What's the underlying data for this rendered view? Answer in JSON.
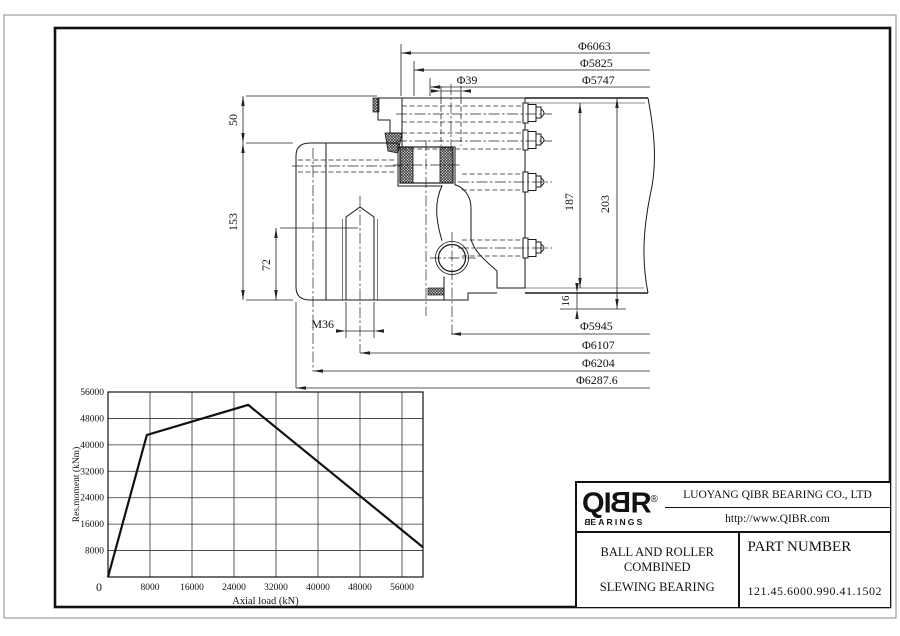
{
  "page": {
    "background": "#ffffff",
    "line_color": "#1a1a1a"
  },
  "drawing": {
    "dims": {
      "d6063": "Φ6063",
      "d5825": "Φ5825",
      "d5747": "Φ5747",
      "d39": "Φ39",
      "d50": "50",
      "d153": "153",
      "d72": "72",
      "d187": "187",
      "d203": "203",
      "d16": "16",
      "m36": "M36",
      "d5945": "Φ5945",
      "d6107": "Φ6107",
      "d6204": "Φ6204",
      "d6287": "Φ6287.6"
    }
  },
  "chart_data": {
    "type": "line",
    "title": "",
    "xlabel": "Axial load (kN)",
    "ylabel": "Res.moment (kNm)",
    "xlim": [
      0,
      60000
    ],
    "ylim": [
      0,
      56000
    ],
    "x_ticks": [
      8000,
      16000,
      24000,
      32000,
      40000,
      48000,
      56000
    ],
    "y_ticks": [
      8000,
      16000,
      24000,
      32000,
      40000,
      48000,
      56000
    ],
    "origin_label": "0",
    "grid": true,
    "legend_position": "none",
    "series": [
      {
        "points": [
          [
            0,
            0
          ],
          [
            7400,
            43000
          ],
          [
            26700,
            52100
          ],
          [
            60000,
            9000
          ]
        ]
      }
    ]
  },
  "title_block": {
    "logo": {
      "q": "Q",
      "i": "I",
      "b": "B",
      "r": "R",
      "reg": "®",
      "sub_first": "B",
      "sub_rest": "EARINGS"
    },
    "company": "LUOYANG QIBR BEARING CO., LTD",
    "url": "http://www.QIBR.com",
    "product_line1": "BALL AND ROLLER COMBINED",
    "product_line2": "SLEWING BEARING",
    "part_number_label": "PART NUMBER",
    "part_number": "121.45.6000.990.41.1502"
  }
}
